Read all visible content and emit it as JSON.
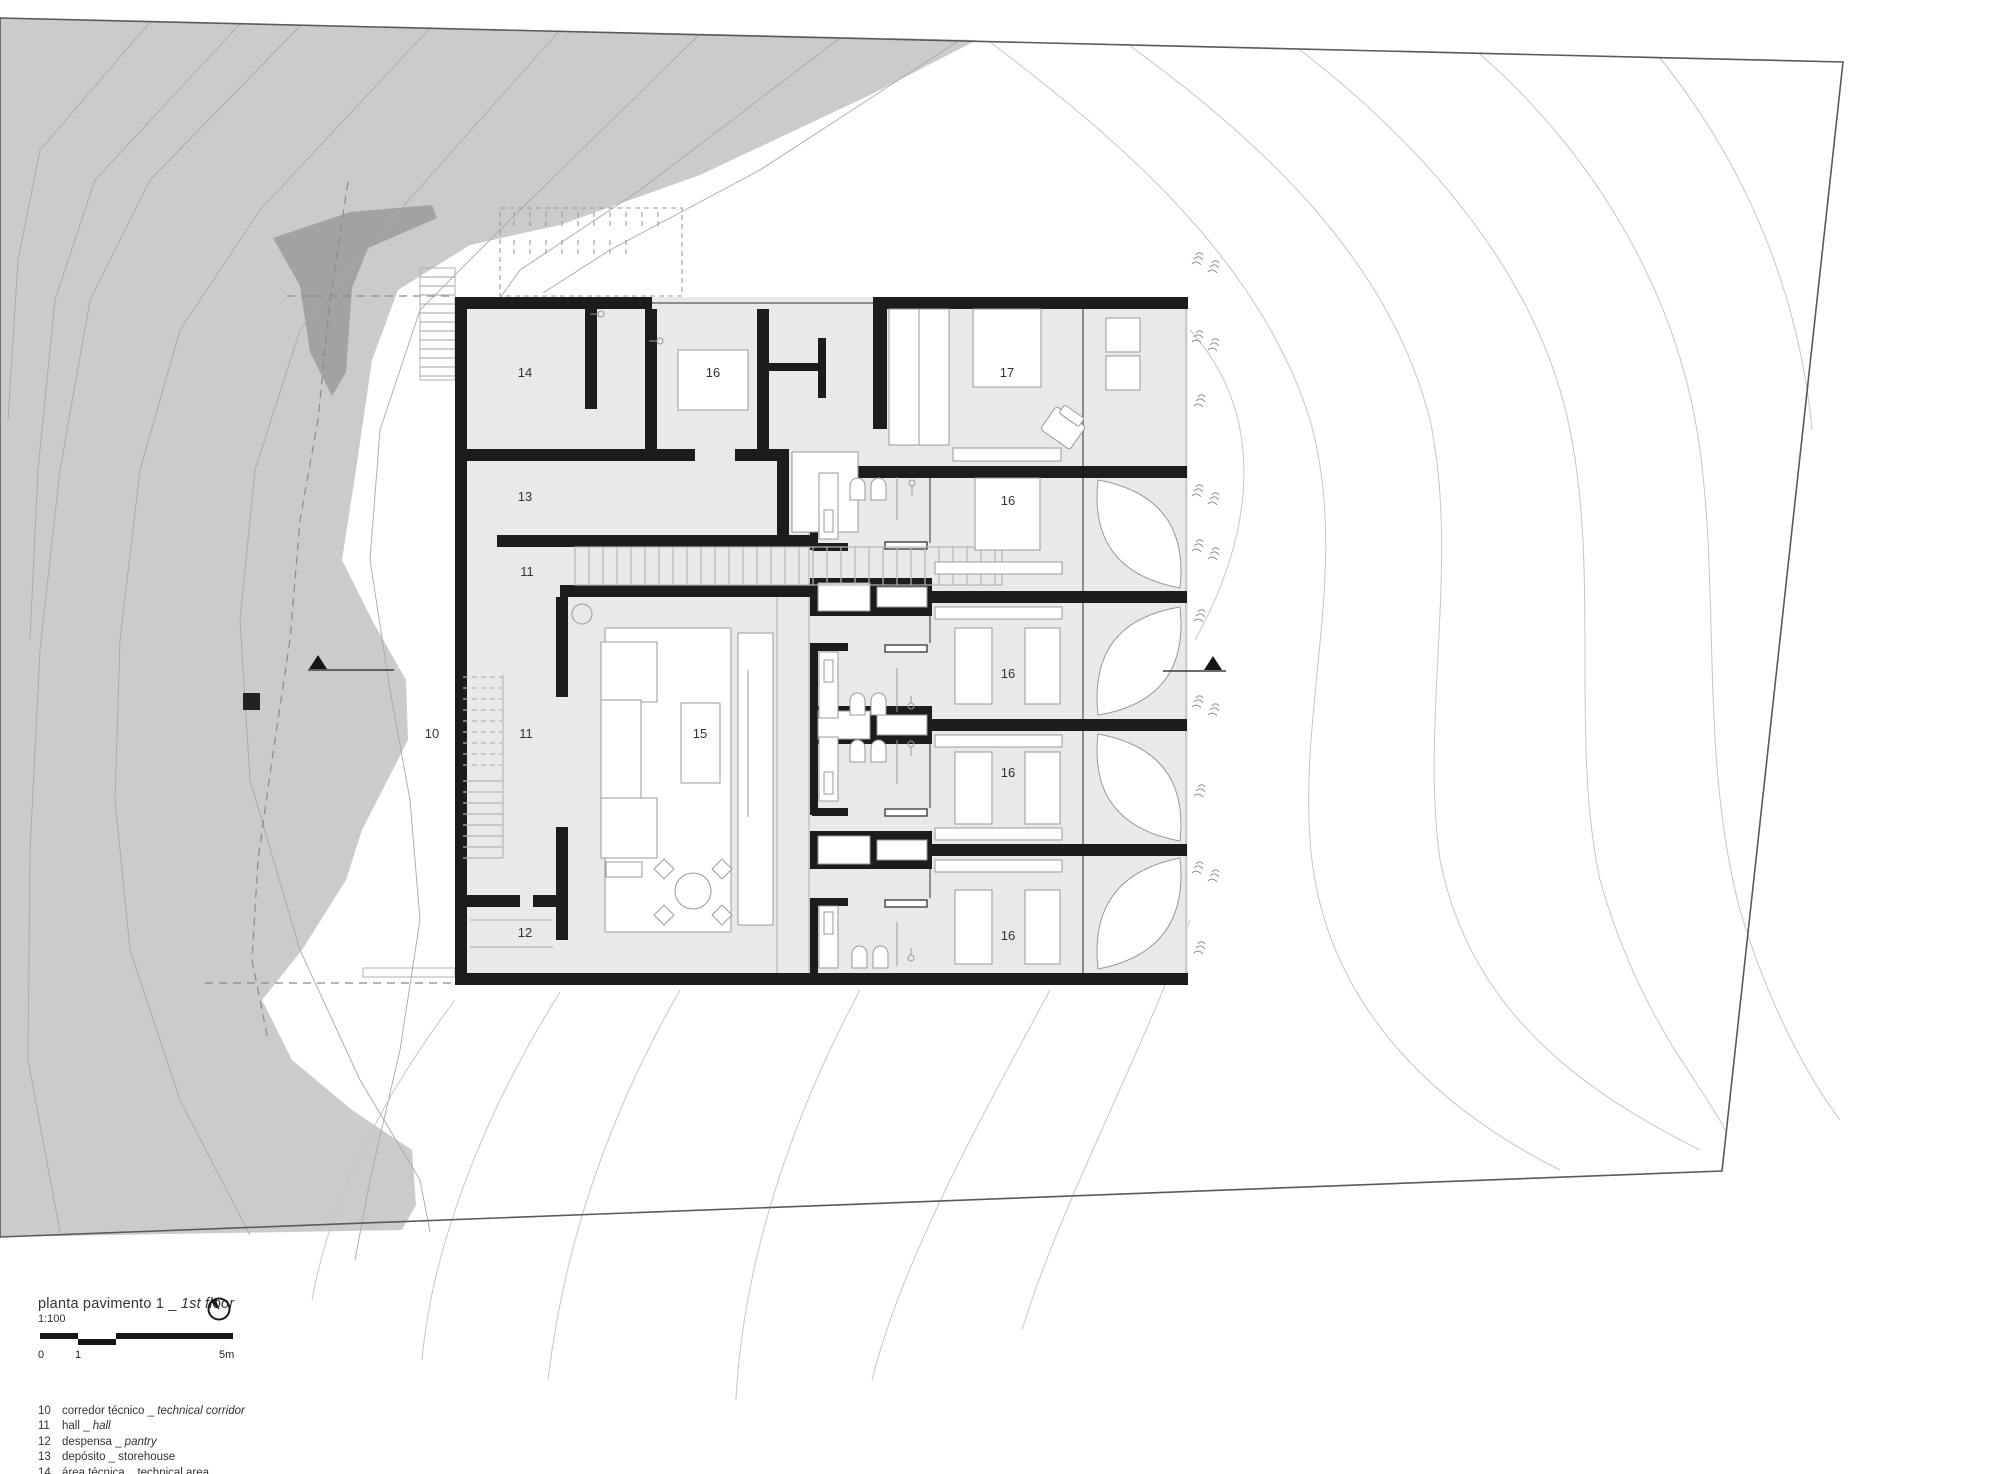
{
  "document": {
    "kind": "architectural floor plan drawing",
    "language": "pt / en"
  },
  "title_block": {
    "title_pt": "planta pavimento 1",
    "separator": " _ ",
    "title_en": "1st floor",
    "scale_ratio": "1:100",
    "north_icon": "north-arrow-icon",
    "scale_bar_labels": {
      "start": "0",
      "one": "1",
      "end": "5m"
    }
  },
  "legend": {
    "items": [
      {
        "num": "10",
        "pt": "corredor técnico",
        "sep": " _ ",
        "en": "technical corridor",
        "en_italic": true
      },
      {
        "num": "11",
        "pt": "hall",
        "sep": " _ ",
        "en": "hall",
        "en_italic": true
      },
      {
        "num": "12",
        "pt": "despensa",
        "sep": " _ ",
        "en": "pantry",
        "en_italic": true
      },
      {
        "num": "13",
        "pt": "depósito",
        "sep": " _ ",
        "en": "storehouse",
        "en_italic": false
      },
      {
        "num": "14",
        "pt": "área técnica",
        "sep": " _ ",
        "en": "technical area",
        "en_italic": false
      },
      {
        "num": "15",
        "pt": "sala de TV",
        "sep": " _ ",
        "en": "TV room",
        "en_italic": true
      },
      {
        "num": "16",
        "pt": "suite",
        "sep": " _ ",
        "en": "en suite bedroom",
        "en_italic": true
      },
      {
        "num": "17",
        "pt": "suite master",
        "sep": " _ ",
        "en": "en suite master bedroom",
        "en_italic": true
      }
    ]
  },
  "plan": {
    "room_labels": [
      {
        "num": "14",
        "x": 525,
        "y": 377
      },
      {
        "num": "16",
        "x": 713,
        "y": 377
      },
      {
        "num": "17",
        "x": 1007,
        "y": 377
      },
      {
        "num": "13",
        "x": 525,
        "y": 501
      },
      {
        "num": "11",
        "x": 527,
        "y": 576
      },
      {
        "num": "16",
        "x": 1008,
        "y": 505
      },
      {
        "num": "10",
        "x": 432,
        "y": 738
      },
      {
        "num": "11",
        "x": 526,
        "y": 738
      },
      {
        "num": "15",
        "x": 700,
        "y": 738
      },
      {
        "num": "16",
        "x": 1008,
        "y": 678
      },
      {
        "num": "16",
        "x": 1008,
        "y": 777
      },
      {
        "num": "12",
        "x": 525,
        "y": 937
      },
      {
        "num": "16",
        "x": 1008,
        "y": 940
      }
    ]
  },
  "colors": {
    "hillside": "#cbcbcb",
    "hillside_dark": "#a2a2a2",
    "floor": "#e9e9e9",
    "wall": "#1c1c1c",
    "furniture_line": "#999999",
    "contour": "#c6c6c6",
    "boundary": "#5a5a5a",
    "text": "#333333"
  }
}
